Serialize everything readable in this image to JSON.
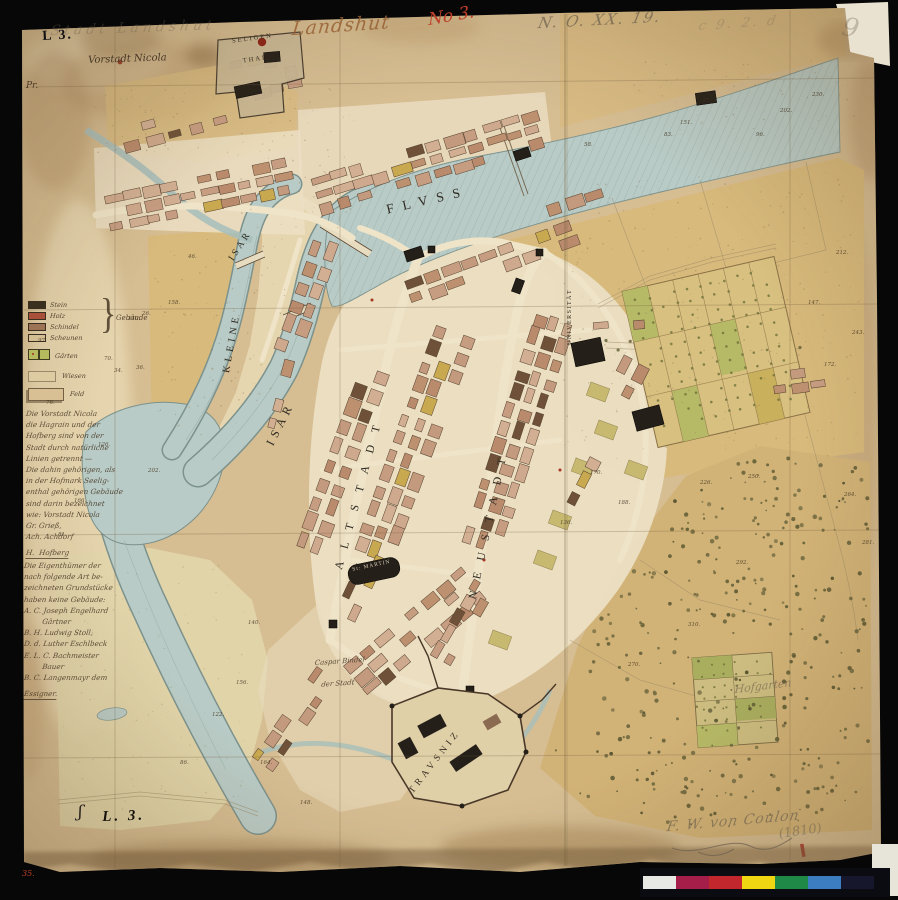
{
  "sheet": {
    "stamp_top_left": "L 3.",
    "pencil_title": "Stadt Landshut",
    "ink_title": "Landshut",
    "red_number": "No 3.",
    "archive_number": "N. O. XX. 19.",
    "archive_scribble": "c 9. 2. d",
    "archive_extra": "9",
    "margin_mark": "Pr.",
    "stamp_bottom_left": "L. 3.",
    "bottom_left_mark": "ʃ",
    "corner_number_red": "35.",
    "signature": "F. W. von Coulon",
    "date": "(1810)"
  },
  "map_labels": {
    "vorstadt_nicola": "Vorstadt Nicola",
    "seligenthal_1": "SELIGEN",
    "seligenthal_2": "THAL",
    "fluss": "FLVSS",
    "isar_big": "ISAR",
    "kleine": "KLEINE",
    "isar_small": "ISAR",
    "altstadt": "ALTSTADT",
    "neustadt": "NEUSTADT",
    "universitaet": "UNIVERSITÄT",
    "st_martin": "St: MARTIN",
    "trausnitz": "TRAVSNIZ",
    "hofgarten": "Hofgarten",
    "caspar_1": "Caspar Bindel",
    "caspar_2": "der Stadt"
  },
  "legend": {
    "building_rows": [
      {
        "label": "Stein",
        "color": "#39301f"
      },
      {
        "label": "Holz",
        "color": "#a8503a"
      },
      {
        "label": "Schindel",
        "color": "#9c7354"
      },
      {
        "label": "Scheunen",
        "color": "#d3bd93"
      }
    ],
    "brace_label": "Gebäude",
    "garden_label": "Gärten",
    "garden_color": "#b5ba5e",
    "wiesen_label": "Wiesen",
    "feld_label": "Feld"
  },
  "notes": {
    "block1": [
      "Die Vorstadt Nicola",
      "die Hagrain und der",
      "Hofberg sind von der",
      "Stadt durch natürliche",
      "Linien getrennt —",
      "Die dahin gehörigen, als",
      "in der Hofmark Seelig-",
      "enthal gehörigen Gebäude",
      "sind darin bezeichnet",
      "wie: Vorstadt Nicola",
      "Gr. Grieß,",
      "Ach. Achdorf",
      "H.  Hofberg"
    ],
    "block2": [
      "Die Eigenthümer der",
      "nach folgende Art be-",
      "zeichneten Grundstücke",
      "haben keine Gebäude:",
      "A. C. Joseph Engelhard",
      "        Gärtner",
      "B. H. Ludwig Stoll,",
      "D. d. Luther Eschlbeck",
      "E. L. C. Bachmeister",
      "        Bauer",
      "B. C. Langenmayr dem",
      "Essigner."
    ]
  },
  "parcels": [
    [
      "97",
      38,
      338
    ],
    [
      "140",
      128,
      316
    ],
    [
      "70",
      104,
      356
    ],
    [
      "36",
      136,
      365
    ],
    [
      "34",
      114,
      368
    ],
    [
      "76",
      46,
      400
    ],
    [
      "126",
      98,
      442
    ],
    [
      "166",
      74,
      498
    ],
    [
      "81",
      58,
      532
    ],
    [
      "202",
      148,
      468
    ],
    [
      "26",
      142,
      311
    ],
    [
      "158",
      168,
      300
    ],
    [
      "46",
      188,
      254
    ],
    [
      "151",
      680,
      120
    ],
    [
      "97",
      702,
      98
    ],
    [
      "83",
      664,
      132
    ],
    [
      "202",
      780,
      108
    ],
    [
      "96",
      756,
      132
    ],
    [
      "230",
      812,
      92
    ],
    [
      "58",
      584,
      142
    ],
    [
      "212",
      836,
      250
    ],
    [
      "147",
      808,
      300
    ],
    [
      "243",
      852,
      330
    ],
    [
      "172",
      824,
      362
    ],
    [
      "264",
      844,
      492
    ],
    [
      "281",
      862,
      540
    ],
    [
      "170",
      590,
      470
    ],
    [
      "188",
      618,
      500
    ],
    [
      "136",
      560,
      520
    ],
    [
      "226",
      700,
      480
    ],
    [
      "250",
      748,
      474
    ],
    [
      "292",
      736,
      560
    ],
    [
      "310",
      688,
      622
    ],
    [
      "270",
      628,
      662
    ],
    [
      "140",
      248,
      620
    ],
    [
      "156",
      236,
      680
    ],
    [
      "122",
      212,
      712
    ],
    [
      "164",
      260,
      760
    ],
    [
      "148",
      300,
      800
    ],
    [
      "86",
      180,
      760
    ]
  ],
  "color_bar": {
    "segments": [
      "#e8e8e4",
      "#a51d49",
      "#c1272d",
      "#eed613",
      "#1f8a47",
      "#3c7cc0",
      "#16162c"
    ]
  },
  "palette": {
    "paper": "#d6bd92",
    "river": "#b9cbc6",
    "field_ochre": "#d8ba7c",
    "block_salmon": "#c79d82",
    "church_black": "#241f18",
    "garden_green": "#b5ba5e",
    "ink_red": "#bf4028"
  }
}
